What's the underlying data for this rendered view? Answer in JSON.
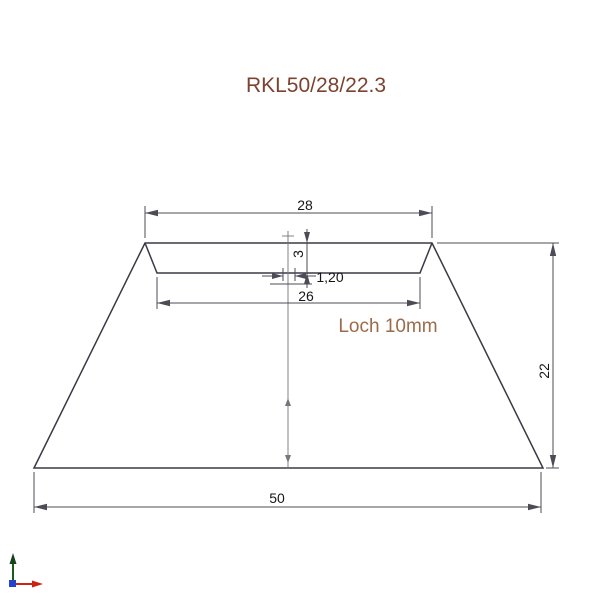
{
  "title": "RKL50/28/22.3",
  "labels": {
    "hole_note": "Loch 10mm"
  },
  "dimensions": {
    "top_width": "28",
    "recess_depth": "3",
    "edge_width": "1,20",
    "recess_width": "26",
    "total_height": "22",
    "base_width": "50"
  },
  "colors": {
    "title_text": "#7c4330",
    "hole_note_text": "#9c6b4a",
    "outline": "#3a3a46",
    "dimension_lines": "#4c4c56",
    "dimension_text": "#161616",
    "axis_x": "#cc2211",
    "axis_y": "#1a5c1a",
    "axis_origin": "#2244cc"
  },
  "icons": {
    "ucs_axis": "coordinate-axes-icon"
  }
}
